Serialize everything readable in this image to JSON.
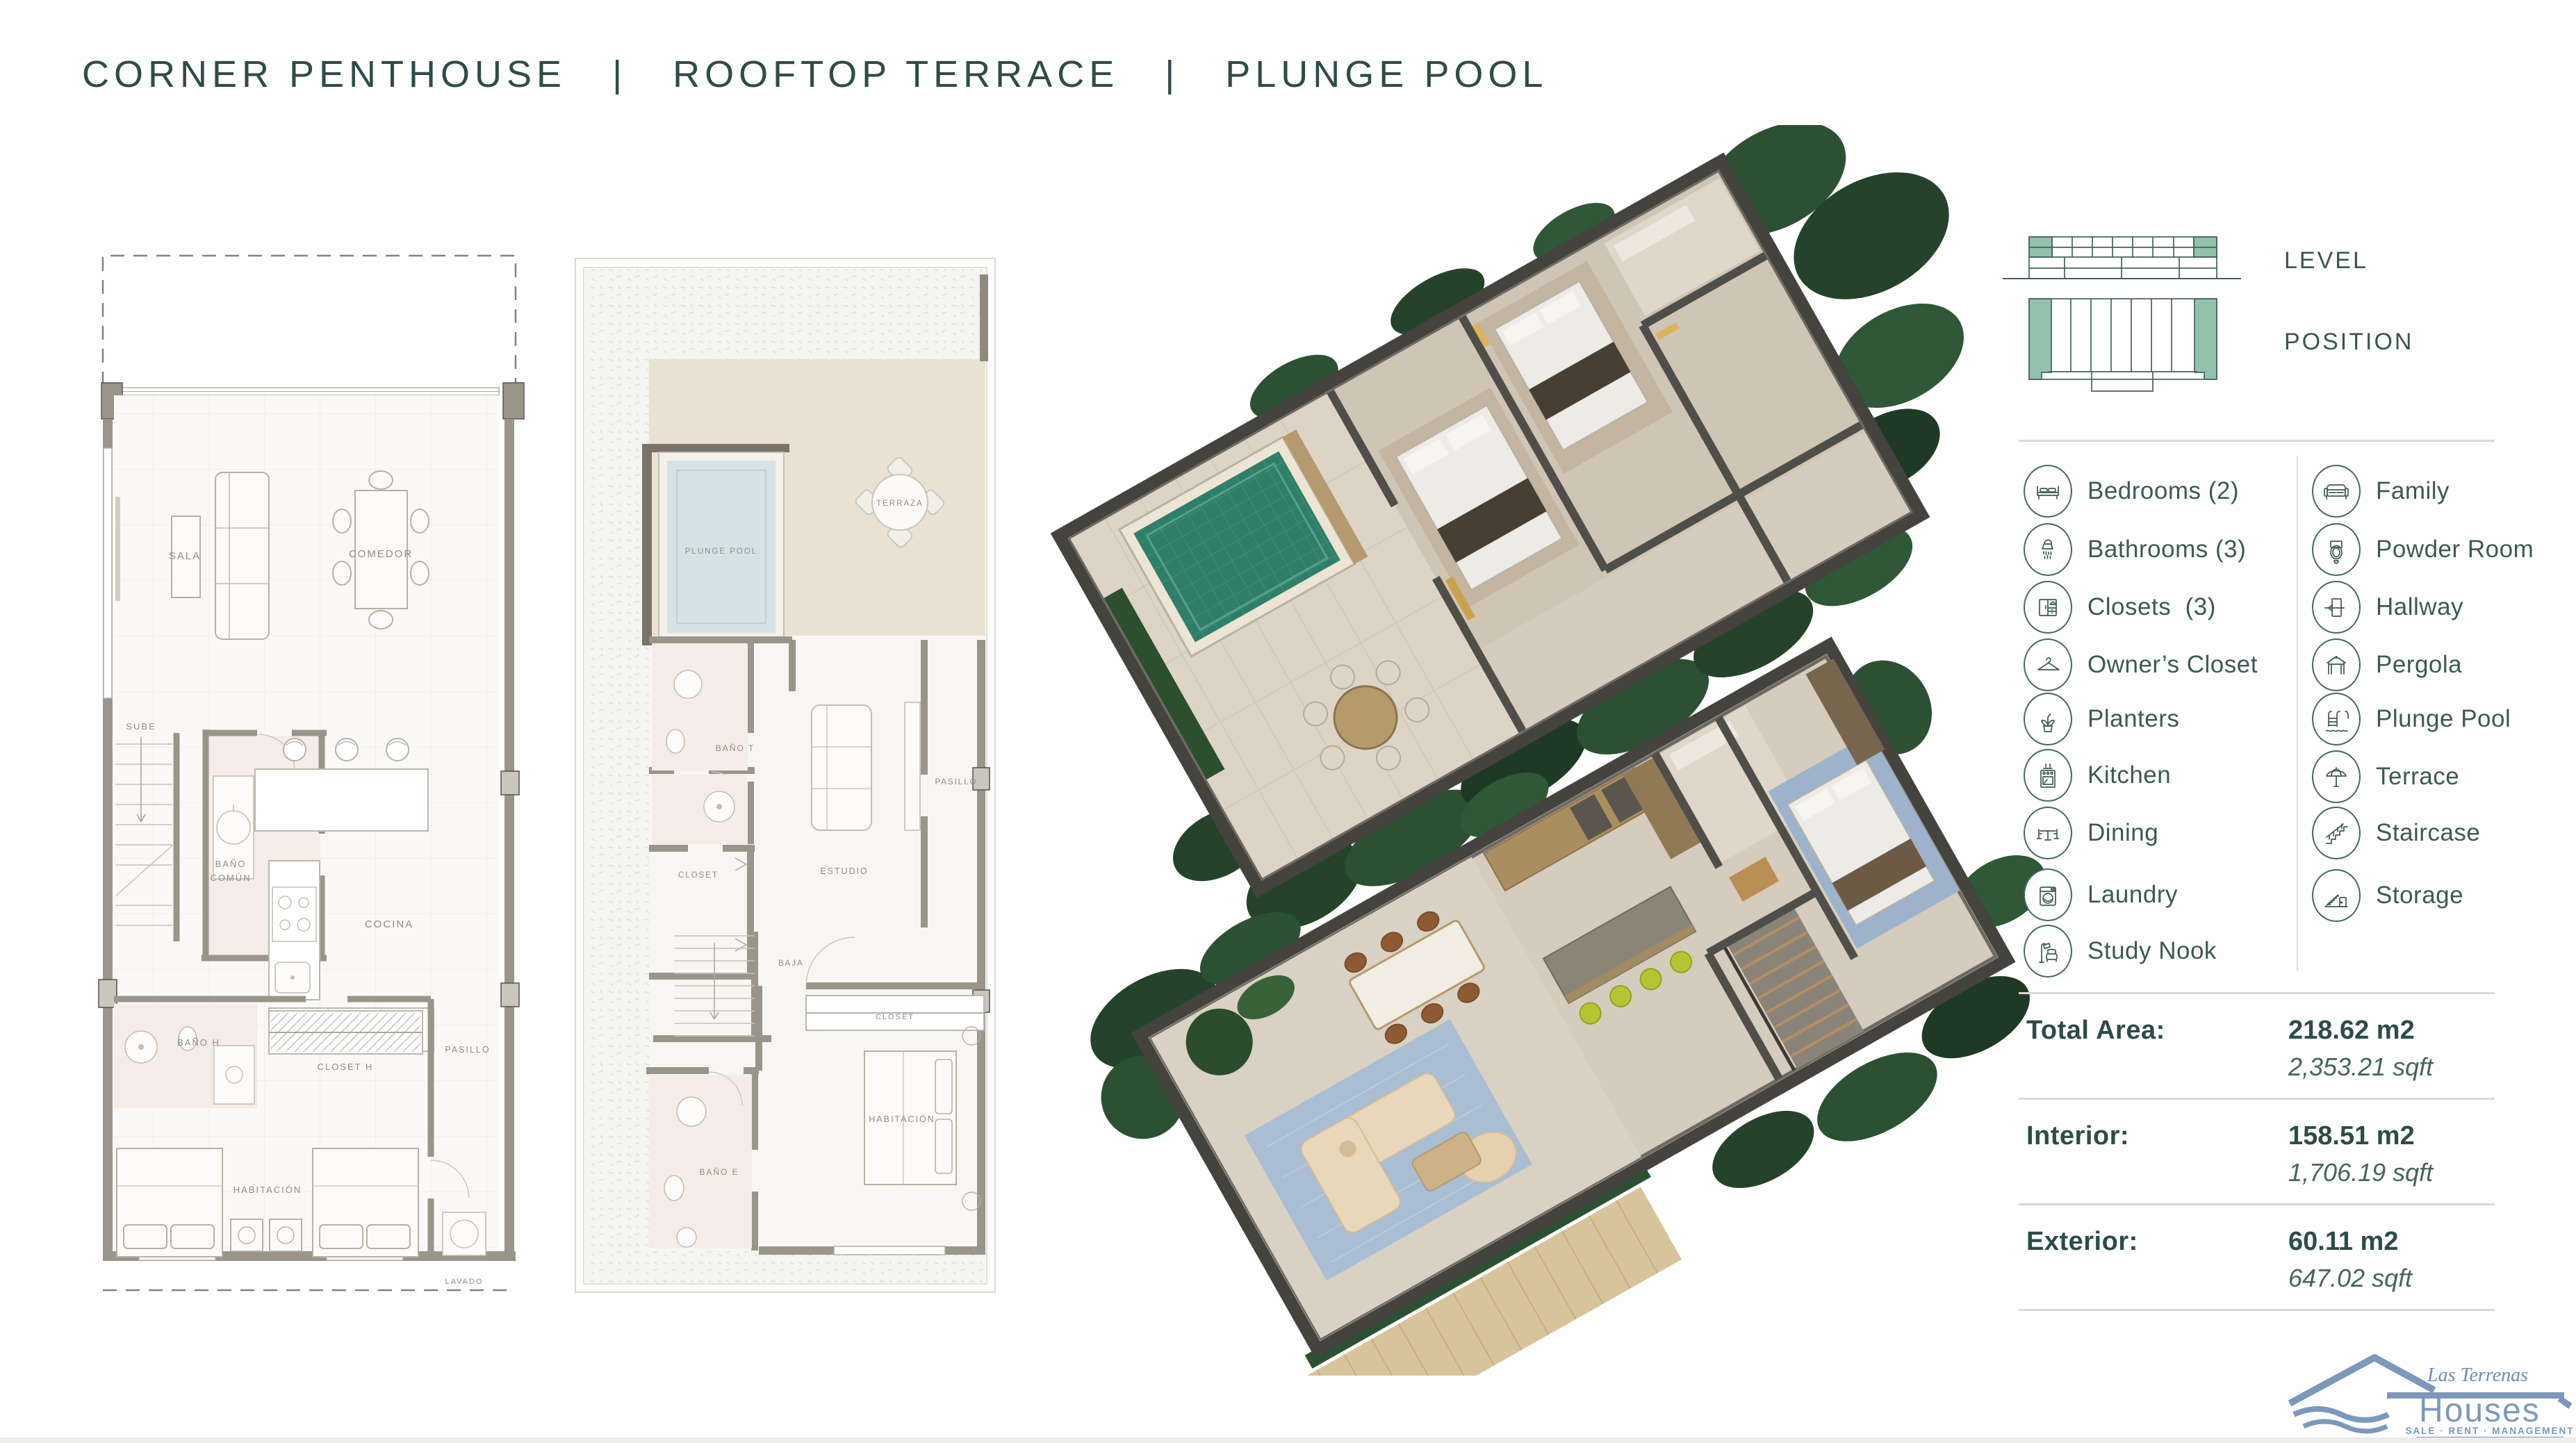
{
  "page": {
    "title": "CORNER PENTHOUSE   |   ROOFTOP TERRACE   |   PLUNGE POOL"
  },
  "unit_diagrams": {
    "level_label": "LEVEL",
    "position_label": "POSITION"
  },
  "legend": {
    "left": [
      {
        "icon": "bed",
        "label": "Bedrooms (2)"
      },
      {
        "icon": "shower",
        "label": "Bathrooms (3)"
      },
      {
        "icon": "wardrobe",
        "label": "Closets  (3)"
      },
      {
        "icon": "hanger",
        "label": "Owner’s Closet"
      },
      {
        "icon": "plant",
        "label": "Planters"
      },
      {
        "icon": "stove",
        "label": "Kitchen"
      },
      {
        "icon": "dining-table",
        "label": "Dining"
      },
      {
        "icon": "washer",
        "label": "Laundry"
      },
      {
        "icon": "study-lamp",
        "label": "Study Nook"
      }
    ],
    "right": [
      {
        "icon": "sofa",
        "label": "Family"
      },
      {
        "icon": "toilet",
        "label": "Powder Room"
      },
      {
        "icon": "door-arrow",
        "label": "Hallway"
      },
      {
        "icon": "pergola",
        "label": "Pergola"
      },
      {
        "icon": "pool-ladder",
        "label": "Plunge Pool"
      },
      {
        "icon": "umbrella",
        "label": "Terrace"
      },
      {
        "icon": "staircase",
        "label": "Staircase"
      },
      {
        "icon": "storage-stairs",
        "label": "Storage"
      }
    ]
  },
  "stats": {
    "rows": [
      {
        "label": "Total Area:",
        "metric": "218.62 m2",
        "imperial": "2,353.21 sqft"
      },
      {
        "label": "Interior:",
        "metric": "158.51 m2",
        "imperial": "1,706.19 sqft"
      },
      {
        "label": "Exterior:",
        "metric": "60.11 m2",
        "imperial": "647.02 sqft"
      }
    ]
  },
  "plan_lower": {
    "labels": {
      "sala": "SALA",
      "comedor": "COMEDOR",
      "sube": "SUBE",
      "bano": "BAÑO",
      "comun": "COMÚN",
      "cocina": "COCINA",
      "lavavajillas": "LAVAVAJILLAS",
      "nevera": "NEVERA",
      "bano_h": "BAÑO H",
      "closet_h": "CLOSET H",
      "pasillo": "PASILLO",
      "habitacion": "HABITACIÓN",
      "lavado": "LAVADO"
    }
  },
  "plan_upper": {
    "labels": {
      "terraza": "TERRAZA",
      "plunge_pool": "PLUNGE POOL",
      "bano_t": "BAÑO T",
      "pasillo": "PASILLO",
      "closet": "CLOSET",
      "estudio": "ESTUDIO",
      "baja": "BAJA",
      "closet2": "CLOSET",
      "habitacion": "HABITACIÓN",
      "bano_e": "BAÑO E"
    }
  },
  "logo": {
    "script": "Las Terrenas",
    "name": "Houses",
    "tagline": "SALE · RENT · MANAGEMENT"
  },
  "colors": {
    "accent_green": "#93c1ab",
    "teal_text": "#2e4c48",
    "logo_blue": "#7c98bb"
  }
}
